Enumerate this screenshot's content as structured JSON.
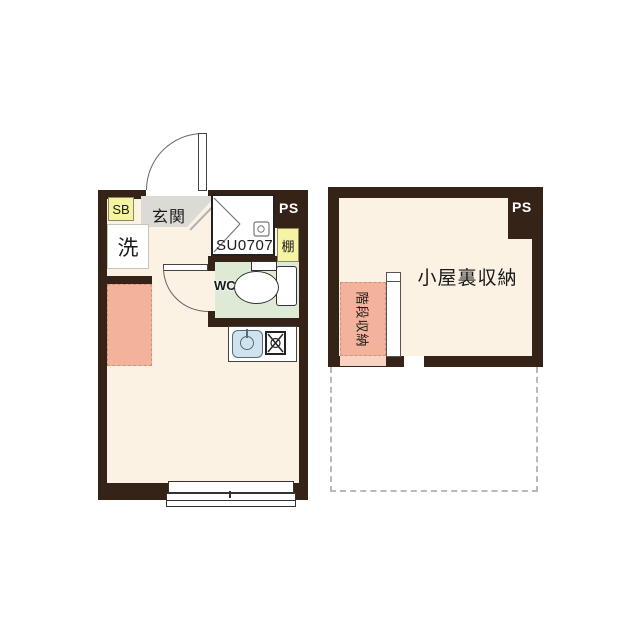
{
  "colors": {
    "wall": "#362318",
    "floor": "#fcf2e4",
    "pink": "#f3b29b",
    "pink-light": "#f8d2c2",
    "green": "#dcead6",
    "yellow": "#f7f3a4",
    "gray": "#dbdad5",
    "sink": "#cfe3ef",
    "dash": "#b9b9b9"
  },
  "plan_1f": {
    "labels": {
      "shoe_box": "SB",
      "entrance": "玄関",
      "washer": "洗",
      "unit_bath": "SU0707",
      "pipe_space": "PS",
      "shelf": "棚",
      "wc": "WC"
    }
  },
  "attic": {
    "labels": {
      "pipe_space": "PS",
      "attic_storage": "小屋裏収納",
      "stair_storage": "階段収納"
    }
  }
}
